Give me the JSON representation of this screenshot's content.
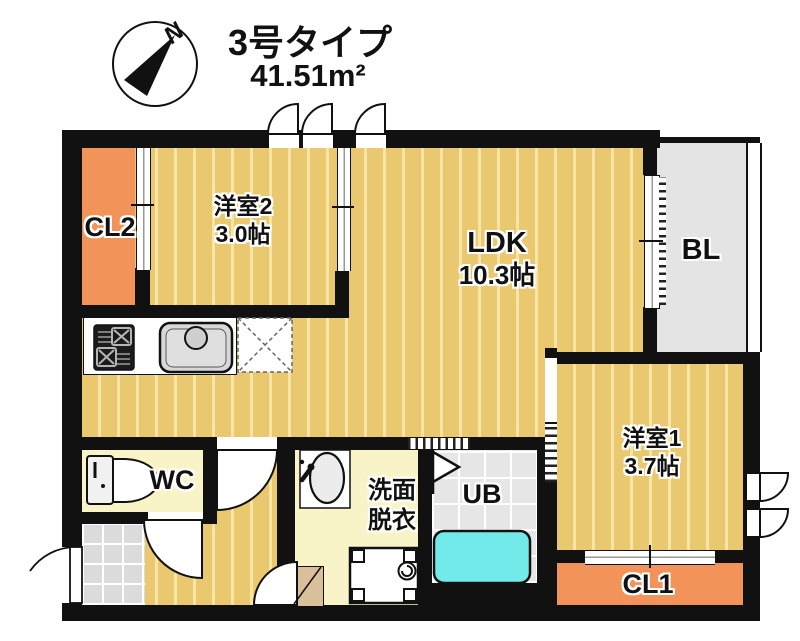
{
  "header": {
    "title": "3号タイプ",
    "area": "41.51m²"
  },
  "compass": {
    "label": "N"
  },
  "rooms": {
    "cl2": {
      "label": "CL2"
    },
    "youshitsu2": {
      "name": "洋室2",
      "size": "3.0帖"
    },
    "ldk": {
      "name": "LDK",
      "size": "10.3帖"
    },
    "bl": {
      "label": "BL"
    },
    "youshitsu1": {
      "name": "洋室1",
      "size": "3.7帖"
    },
    "wc": {
      "label": "WC"
    },
    "senmen": {
      "line1": "洗面",
      "line2": "脱衣"
    },
    "ub": {
      "label": "UB"
    },
    "cl1": {
      "label": "CL1"
    }
  },
  "colors": {
    "floor": "#E9C870",
    "floor_stripe": "#F6E5A4",
    "closet": "#F2935A",
    "wet_room": "#F8F4C8",
    "balcony": "#E4E4E4",
    "bathtub": "#73EAEA",
    "wall": "#111111"
  }
}
